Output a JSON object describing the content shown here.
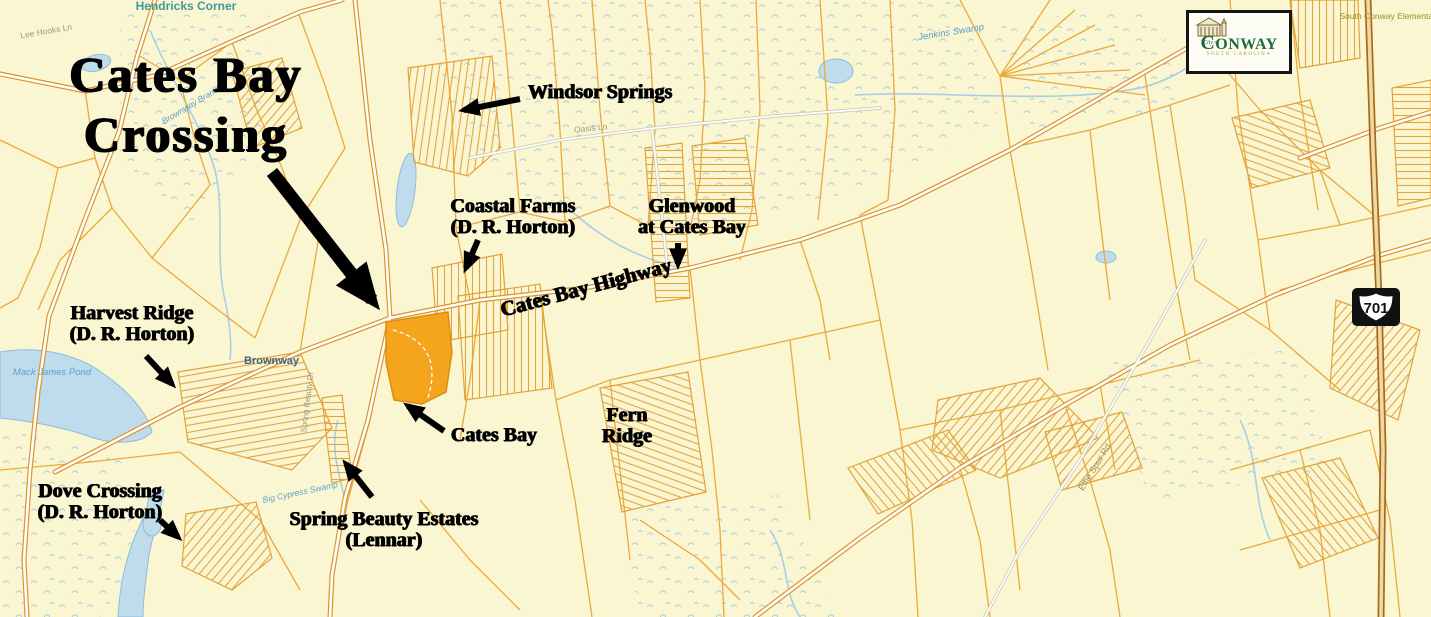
{
  "title": {
    "line1": "Cates Bay",
    "line2": "Crossing"
  },
  "annotations": {
    "windsor_springs": {
      "label": "Windsor Springs"
    },
    "coastal_farms": {
      "line1": "Coastal Farms",
      "line2": "(D. R. Horton)"
    },
    "glenwood": {
      "line1": "Glenwood",
      "line2": "at Cates Bay"
    },
    "harvest_ridge": {
      "line1": "Harvest Ridge",
      "line2": "(D. R. Horton)"
    },
    "cates_bay_site": {
      "label": "Cates Bay"
    },
    "fern_ridge": {
      "line1": "Fern",
      "line2": "Ridge"
    },
    "dove_crossing": {
      "line1": "Dove Crossing",
      "line2": "(D. R. Horton)"
    },
    "spring_beauty": {
      "line1": "Spring Beauty Estates",
      "line2": "(Lennar)"
    },
    "highway": {
      "label": "Cates Bay Highway"
    }
  },
  "map_labels": {
    "hendricks_corner": {
      "line1": "Hendricks",
      "line2": "Corner"
    },
    "lee_hooks_ln": "Lee Hooks Ln",
    "brownway_branch": "Brownway Branch",
    "oasis_ln": "Oasis Ln",
    "jenkins_swamp": "Jenkins Swamp",
    "mack_james_pond": {
      "line1": "Mack James",
      "line2": "Pond"
    },
    "brownway": "Brownway",
    "big_cypress_swamp": "Big Cypress Swamp",
    "spring_beauty_dr": "Spring Beauty Dr",
    "effie_spur_rd": "Effie Spur Rd",
    "school": {
      "line1": "South Conway",
      "line2": "Elementary",
      "line3": "School"
    }
  },
  "highway_shield": {
    "number": "701"
  },
  "logo": {
    "city_of": "City of",
    "name_start": "C",
    "name_rest": "ONWAY",
    "state": "SOUTH CAROLINA"
  },
  "colors": {
    "background": "#FAF6D2",
    "parcel_line": "#E9A93C",
    "road_casing": "#DB9430",
    "site_highlight": "#F5A51D",
    "water": "#BFDCEC",
    "annotation_text": "#000000",
    "place_label": "#3D9A98",
    "water_label": "#5FA0C8",
    "logo_green": "#1E6B34",
    "logo_gold": "#B5A02A"
  }
}
